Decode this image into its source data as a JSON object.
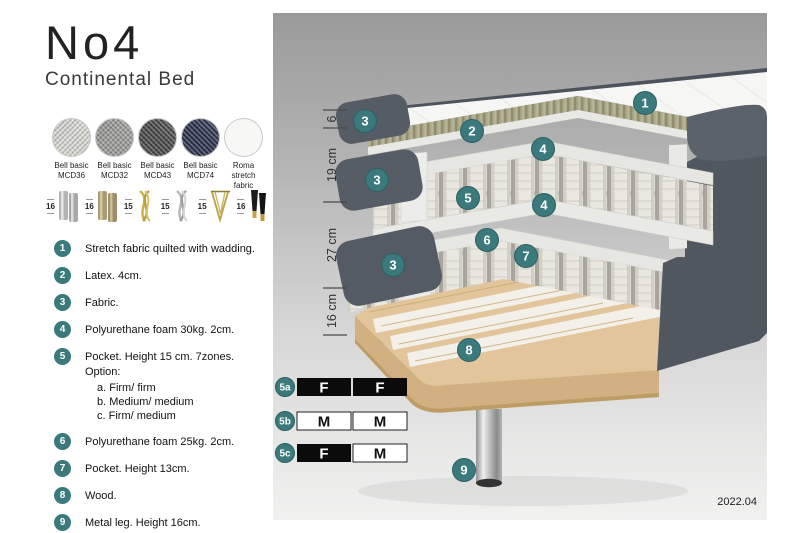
{
  "title": {
    "name": "No4",
    "subtitle": "Continental Bed"
  },
  "fabrics": [
    {
      "name": "Bell basic",
      "code": "MCD36",
      "color": "#d9d8d4"
    },
    {
      "name": "Bell basic",
      "code": "MCD32",
      "color": "#9c9c9a"
    },
    {
      "name": "Bell basic",
      "code": "MCD43",
      "color": "#4b4b4b"
    },
    {
      "name": "Bell basic",
      "code": "MCD74",
      "color": "#2e3450"
    },
    {
      "name": "Roma",
      "code": "stretch fabric",
      "color": "#f7f7f6"
    }
  ],
  "legs": [
    {
      "height": "16",
      "type": "cylinder-pair-silver"
    },
    {
      "height": "16",
      "type": "cylinder-pair-brass"
    },
    {
      "height": "15",
      "type": "twisted-gold"
    },
    {
      "height": "15",
      "type": "twisted-silver"
    },
    {
      "height": "15",
      "type": "hairpin-gold"
    },
    {
      "height": "16",
      "type": "tapered-black-gold-tip"
    }
  ],
  "list": [
    {
      "n": "1",
      "text": "Stretch fabric quilted with wadding."
    },
    {
      "n": "2",
      "text": "Latex. 4cm."
    },
    {
      "n": "3",
      "text": "Fabric."
    },
    {
      "n": "4",
      "text": "Polyurethane foam 30kg. 2cm."
    },
    {
      "n": "5",
      "text": "Pocket. Height 15 cm. 7zones. Option:",
      "options": [
        "a. Firm/ firm",
        "b. Medium/ medium",
        "c. Firm/ medium"
      ]
    },
    {
      "n": "6",
      "text": "Polyurethane foam 25kg. 2cm."
    },
    {
      "n": "7",
      "text": "Pocket. Height 13cm."
    },
    {
      "n": "8",
      "text": "Wood."
    },
    {
      "n": "9",
      "text": "Metal leg. Height 16cm."
    }
  ],
  "illustration": {
    "measurements": [
      {
        "label": "6"
      },
      {
        "label": "19 cm"
      },
      {
        "label": "27 cm"
      },
      {
        "label": "16 cm"
      }
    ],
    "badges": [
      {
        "n": "1"
      },
      {
        "n": "3"
      },
      {
        "n": "2"
      },
      {
        "n": "4"
      },
      {
        "n": "3"
      },
      {
        "n": "5"
      },
      {
        "n": "4"
      },
      {
        "n": "6"
      },
      {
        "n": "7"
      },
      {
        "n": "3"
      },
      {
        "n": "8"
      },
      {
        "n": "9"
      }
    ],
    "firmness": [
      {
        "label": "5a",
        "left": "F",
        "right": "F"
      },
      {
        "label": "5b",
        "left": "M",
        "right": "M"
      },
      {
        "label": "5c",
        "left": "F",
        "right": "M"
      }
    ],
    "version": "2022.04"
  },
  "colors": {
    "accent_teal": "#3a7a7c",
    "firmness_filled": "#0b0b0b",
    "firmness_empty": "#ffffff",
    "fabric_dark_gray": "#545a63",
    "latex_olive": "#aca98b",
    "wood_tan": "#e2c59a",
    "panel_gray_top": "#9a9a9a",
    "panel_gray_bottom": "#f1f1f0"
  }
}
